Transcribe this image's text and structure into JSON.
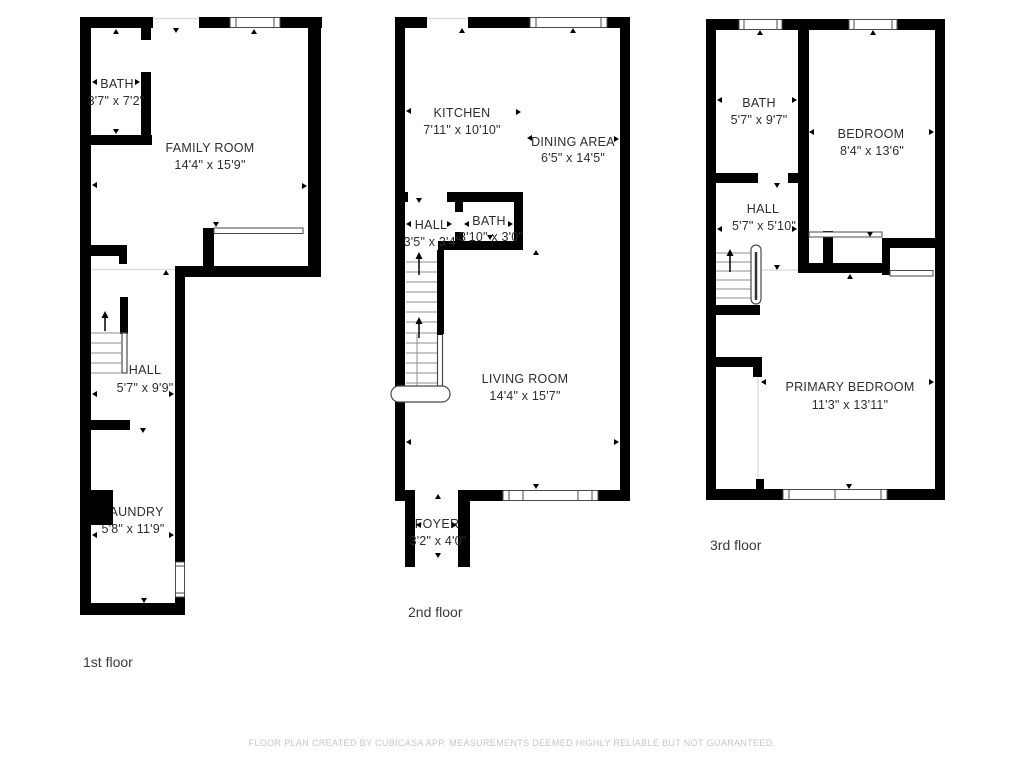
{
  "document": {
    "type": "floor-plan",
    "creator_app": "CubiCasa"
  },
  "floors": [
    {
      "label": "1st floor",
      "rooms": [
        {
          "name": "BATH",
          "dims": "3'7\" x 7'2\""
        },
        {
          "name": "FAMILY ROOM",
          "dims": "14'4\" x 15'9\""
        },
        {
          "name": "HALL",
          "dims": "5'7\" x 9'9\""
        },
        {
          "name": "LAUNDRY",
          "dims": "5'8\" x 11'9\""
        }
      ]
    },
    {
      "label": "2nd floor",
      "rooms": [
        {
          "name": "KITCHEN",
          "dims": "7'11\" x 10'10\""
        },
        {
          "name": "DINING AREA",
          "dims": "6'5\" x 14'5\""
        },
        {
          "name": "HALL",
          "dims": "3'5\" x 3'4\""
        },
        {
          "name": "BATH",
          "dims": "3'10\" x 3'0\""
        },
        {
          "name": "LIVING ROOM",
          "dims": "14'4\" x 15'7\""
        },
        {
          "name": "FOYER",
          "dims": "3'2\" x 4'0\""
        }
      ]
    },
    {
      "label": "3rd floor",
      "rooms": [
        {
          "name": "BATH",
          "dims": "5'7\" x 9'7\""
        },
        {
          "name": "BEDROOM",
          "dims": "8'4\" x 13'6\""
        },
        {
          "name": "HALL",
          "dims": "5'7\" x 5'10\""
        },
        {
          "name": "PRIMARY BEDROOM",
          "dims": "11'3\" x 13'11\""
        }
      ]
    }
  ],
  "footer": {
    "disclaimer": "FLOOR PLAN CREATED BY CUBICASA APP. MEASUREMENTS DEEMED HIGHLY RELIABLE BUT NOT GUARANTEED."
  },
  "colors": {
    "wall": "#000000",
    "text": "#2d2d2d",
    "footer": "#c6c6c6",
    "background": "#ffffff"
  }
}
